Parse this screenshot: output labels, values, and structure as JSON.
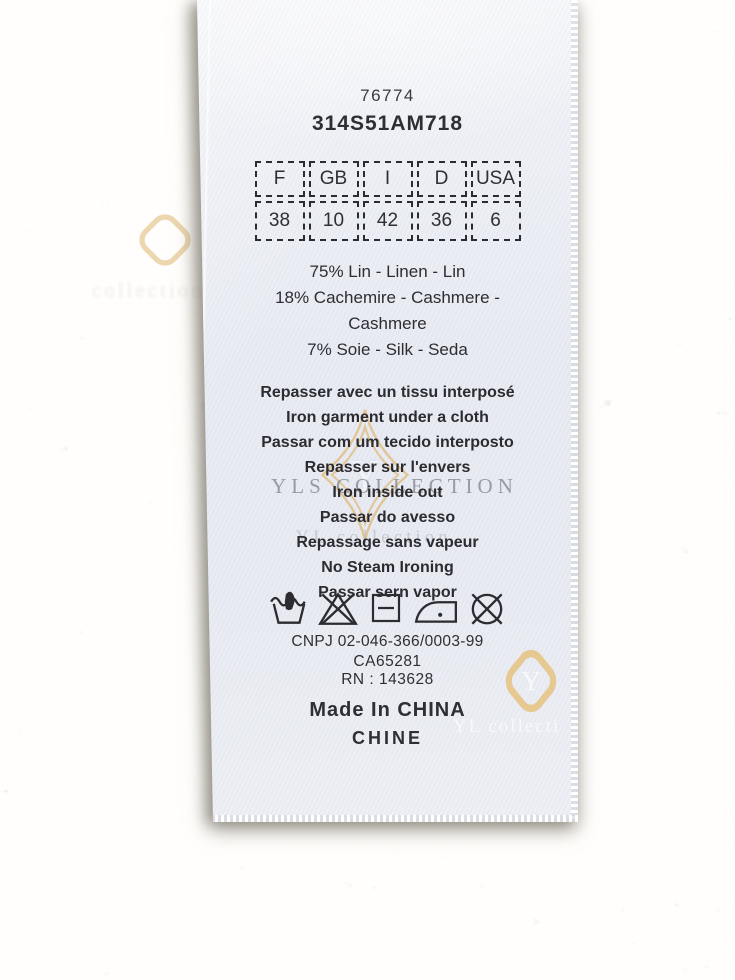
{
  "label": {
    "product_code": "76774",
    "style_code": "314S51AM718",
    "size_table": {
      "headers": [
        "F",
        "GB",
        "I",
        "D",
        "USA"
      ],
      "values": [
        "38",
        "10",
        "42",
        "36",
        "6"
      ]
    },
    "composition_lines": [
      "75% Lin - Linen - Lin",
      "18% Cachemire - Cashmere -",
      "Cashmere",
      "7% Soie - Silk - Seda"
    ],
    "care_lines": [
      "Repasser avec un tissu interposé",
      "Iron garment under a cloth",
      "Passar com um tecido interposto",
      "Repasser sur l'envers",
      "Iron inside out",
      "Passar do avesso",
      "Repassage sans vapeur",
      "No Steam Ironing",
      "Passar sern vapor"
    ],
    "care_symbols": [
      "hand-wash",
      "do-not-bleach",
      "dry-flat",
      "iron-low-heat",
      "do-not-dry-clean"
    ],
    "registration": {
      "cnpj": "CNPJ 02-046-366/0003-99",
      "ca": "CA65281",
      "rn": "RN : 143628"
    },
    "origin_lines": [
      "Made In CHINA",
      "CHINE"
    ]
  },
  "watermarks": {
    "center_text": "YLS COLLECTION",
    "secondary_text": "YL collection",
    "corner_text": "collection",
    "bottom_text": "YL collecti",
    "monogram": "Y",
    "gold_color": "#e0b96e",
    "gray_color": "#7a818c"
  },
  "colors": {
    "fabric_base": "#ccc7bb",
    "label_tint": "#e8eaf2",
    "ink": "#2e2e33"
  }
}
